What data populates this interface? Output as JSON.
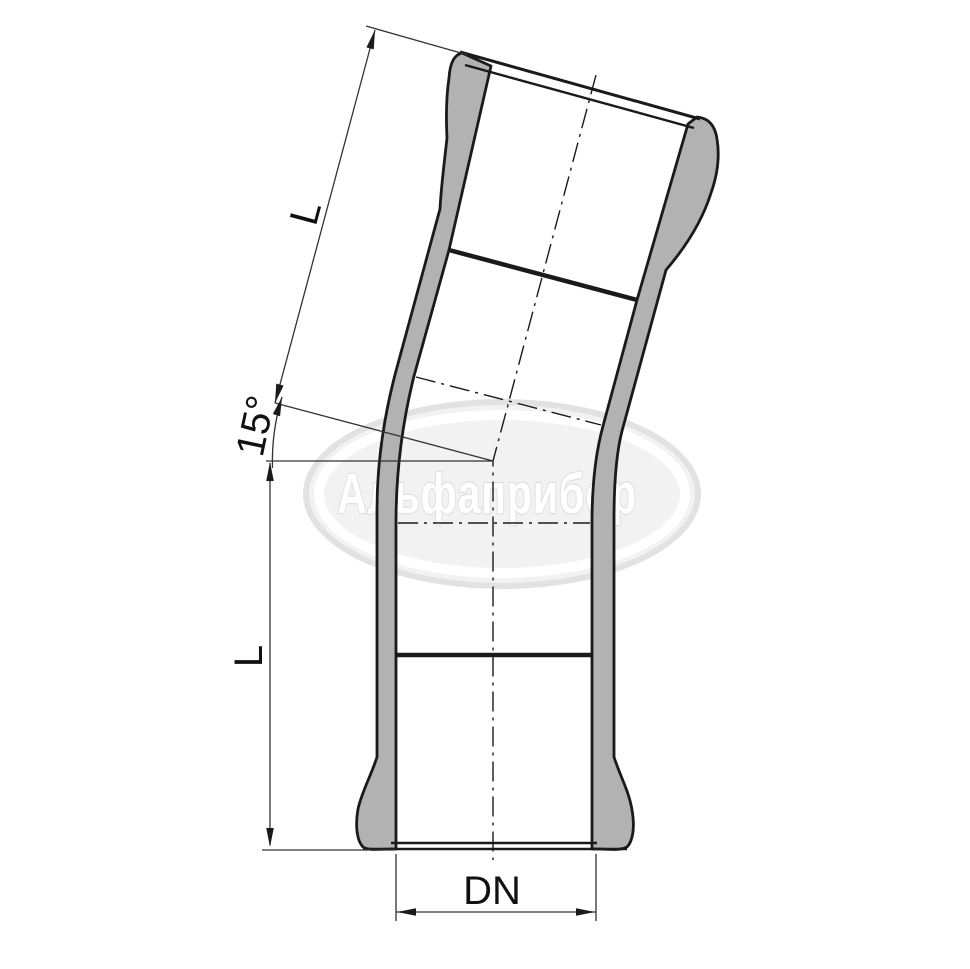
{
  "drawing": {
    "labels": {
      "upper_length": "L",
      "lower_length": "L",
      "angle": "15°",
      "diameter": "DN"
    },
    "watermark": {
      "text": "Альфаприбор"
    },
    "colors": {
      "background": "#ffffff",
      "line": "#1a1a1a",
      "dim_line": "#333333",
      "wall_fill": "#b2b2b2",
      "watermark_fill": "#f2f2f2",
      "watermark_edge": "#e2e2e2",
      "watermark_ring": "#ffffff",
      "watermark_text": "#ffffff"
    }
  }
}
